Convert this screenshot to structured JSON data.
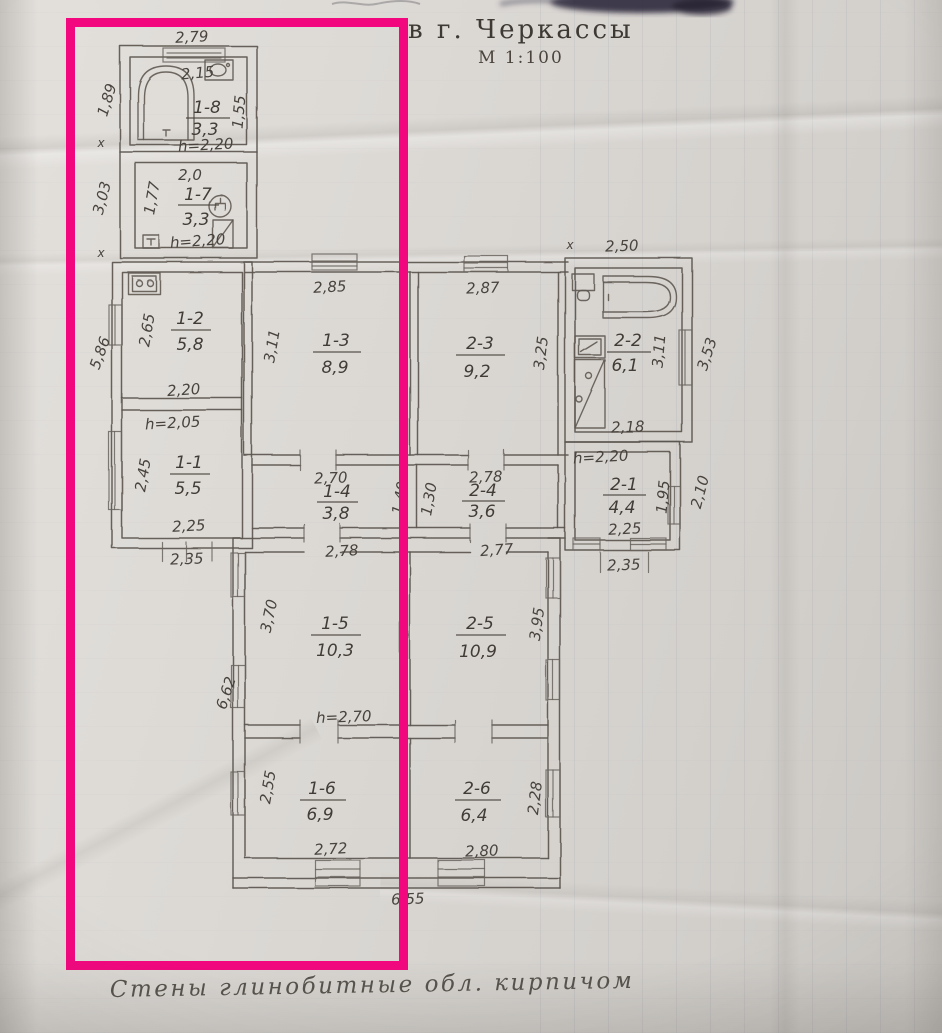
{
  "document": {
    "title": "в г. Черкассы",
    "scale_label": "М 1:100",
    "footnote": "Стены глинобитные обл. кирпичом"
  },
  "highlight": {
    "color": "#f2077f",
    "border_style": "border:9px solid #f2077f"
  },
  "palette": {
    "pencil": "#5b554f",
    "paper": "#d8d5d1",
    "ink_smudge": "#2a2438"
  },
  "rooms": [
    {
      "id": "1-8",
      "area": "3,3"
    },
    {
      "id": "1-7",
      "area": "3,3"
    },
    {
      "id": "1-2",
      "area": "5,8"
    },
    {
      "id": "1-3",
      "area": "8,9"
    },
    {
      "id": "2-3",
      "area": "9,2"
    },
    {
      "id": "2-2",
      "area": "6,1"
    },
    {
      "id": "1-1",
      "area": "5,5"
    },
    {
      "id": "1-4",
      "area": "3,8"
    },
    {
      "id": "2-4",
      "area": "3,6"
    },
    {
      "id": "2-1",
      "area": "4,4"
    },
    {
      "id": "1-5",
      "area": "10,3"
    },
    {
      "id": "2-5",
      "area": "10,9"
    },
    {
      "id": "1-6",
      "area": "6,9"
    },
    {
      "id": "2-6",
      "area": "6,4"
    }
  ],
  "dims": {
    "d279": "2,79",
    "d215": "2,15",
    "d189": "1,89",
    "d155": "1,55",
    "h220a": "h=2,20",
    "d20": "2,0",
    "d177": "1,77",
    "d303": "3,03",
    "h220b": "h=2,20",
    "d250": "2,50",
    "d285": "2,85",
    "d287": "2,87",
    "d311a": "3,11",
    "d325": "3,25",
    "d265": "2,65",
    "d586": "5,86",
    "d220": "2,20",
    "d311b": "3,11",
    "d353": "3,53",
    "d218": "2,18",
    "h205": "h=2,05",
    "d245": "2,45",
    "d225a": "2,25",
    "d235a": "2,35",
    "d270": "2,70",
    "d140": "1,40",
    "d130": "1,30",
    "d278a": "2,78",
    "h220c": "h=2,20",
    "d195": "1,95",
    "d210": "2,10",
    "d225b": "2,25",
    "d235b": "2,35",
    "d278b": "2,78",
    "d277": "2,77",
    "d370": "3,70",
    "d395": "3,95",
    "d662": "6,62",
    "h270": "h=2,70",
    "d255": "2,55",
    "d228": "2,28",
    "d272": "2,72",
    "d280": "2,80",
    "d655": "6,55"
  },
  "marks": {
    "x": "x"
  }
}
